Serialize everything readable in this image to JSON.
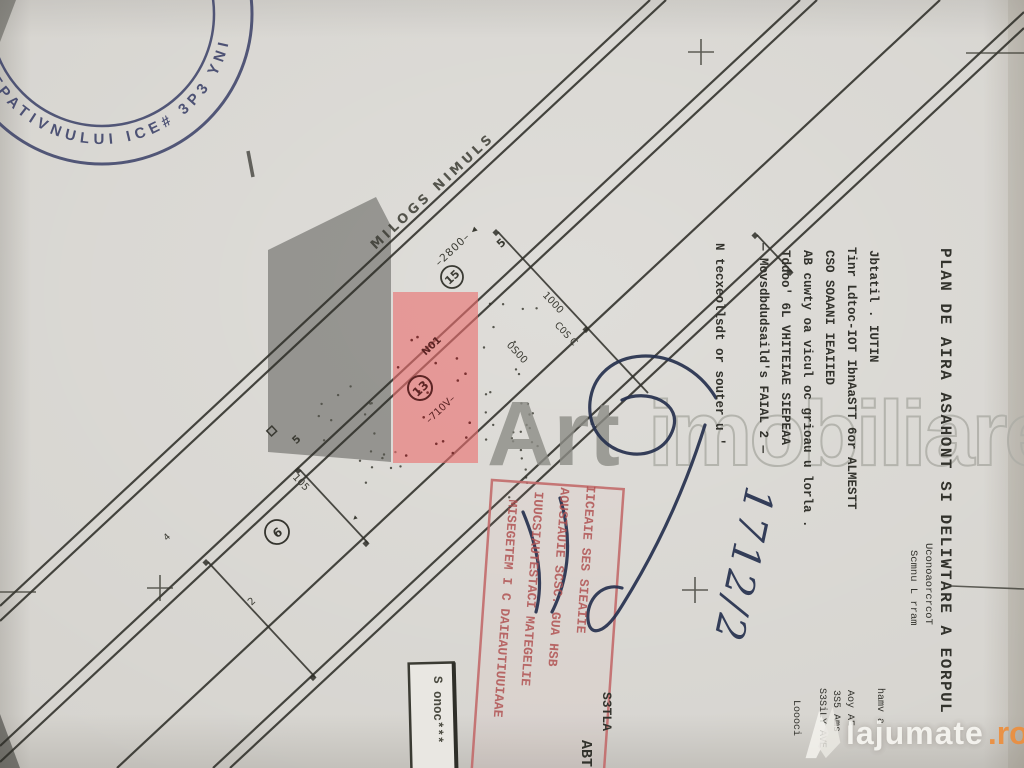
{
  "colors": {
    "paper": "#d6d4cf",
    "ink": "#2f2f29",
    "parcel_red": "#ea6f6f",
    "overlay_gray": "#555550",
    "stamp_blue": "#343a63",
    "stamp_red": "#b85555",
    "pen_blue": "#25304e",
    "watermark_gray": "#8d8d86",
    "brand_orange": "#ec8f3e"
  },
  "stamp_round": {
    "arc_text": "OSTPATIVNULUI ICE# 3P3 YNIC"
  },
  "plan": {
    "road_name": "MILOGS NIMULS",
    "dim_road": "–2800– ◂",
    "pt_5": "5",
    "dim_1000": "1000",
    "dim_0500": "0S00",
    "lbl_cos": "C0S C",
    "lbl_n01": "N01",
    "dim_710": "–710V–",
    "dim_105": "105",
    "lbl_2": "2",
    "lbl_4": "4",
    "lbl_5b": "5",
    "arrow": "◂",
    "circled": [
      "15",
      "13",
      "6"
    ]
  },
  "title_block": {
    "title": "PLAN DE AIRA ASAHONT SI DELIWTARE A EORPUL",
    "subtitle1": "UconoaorcrcoT",
    "subtitle2": "Scmnu L rram",
    "lines": [
      "Jbtatil . IUTIN",
      "Tinr Ldtoc-IOT IbnAaSTT 6or ALMESTT",
      "CSO SOAANI IEAIIED",
      "AB cuwty oa vicul oc grioau u lorla .",
      "Tddoo' 6L VHITEIAE SIEPEAA",
      "— Movsdbdudsaild's FAIAL 2 —",
      "N tecxeollsdt or souter u '"
    ]
  },
  "corner_block": {
    "lines": [
      "Loooci",
      "S3SiLY AVE",
      "3S5 Ams",
      "Aoy AE",
      "hamv a"
    ]
  },
  "side_labels": {
    "s3tla": "S3TLA",
    "abt": "ABT"
  },
  "red_stamp": {
    "lines": [
      "MISEGETEM I C DAIEAUTIUUIAAE",
      "IUUCSIAUTESTACI MATEGELIE",
      "AOUSIAUIE SCSC. GUA HSB",
      "IICEAIE SES SIEAIIE"
    ]
  },
  "handwriting": {
    "number": "1712/2"
  },
  "box_label": {
    "text": "S onoc***"
  },
  "watermark_center": {
    "solid": "Art",
    "outline": "imobiliare"
  },
  "watermark_corner": {
    "brand": "lajumate",
    "tld": ".ro"
  }
}
